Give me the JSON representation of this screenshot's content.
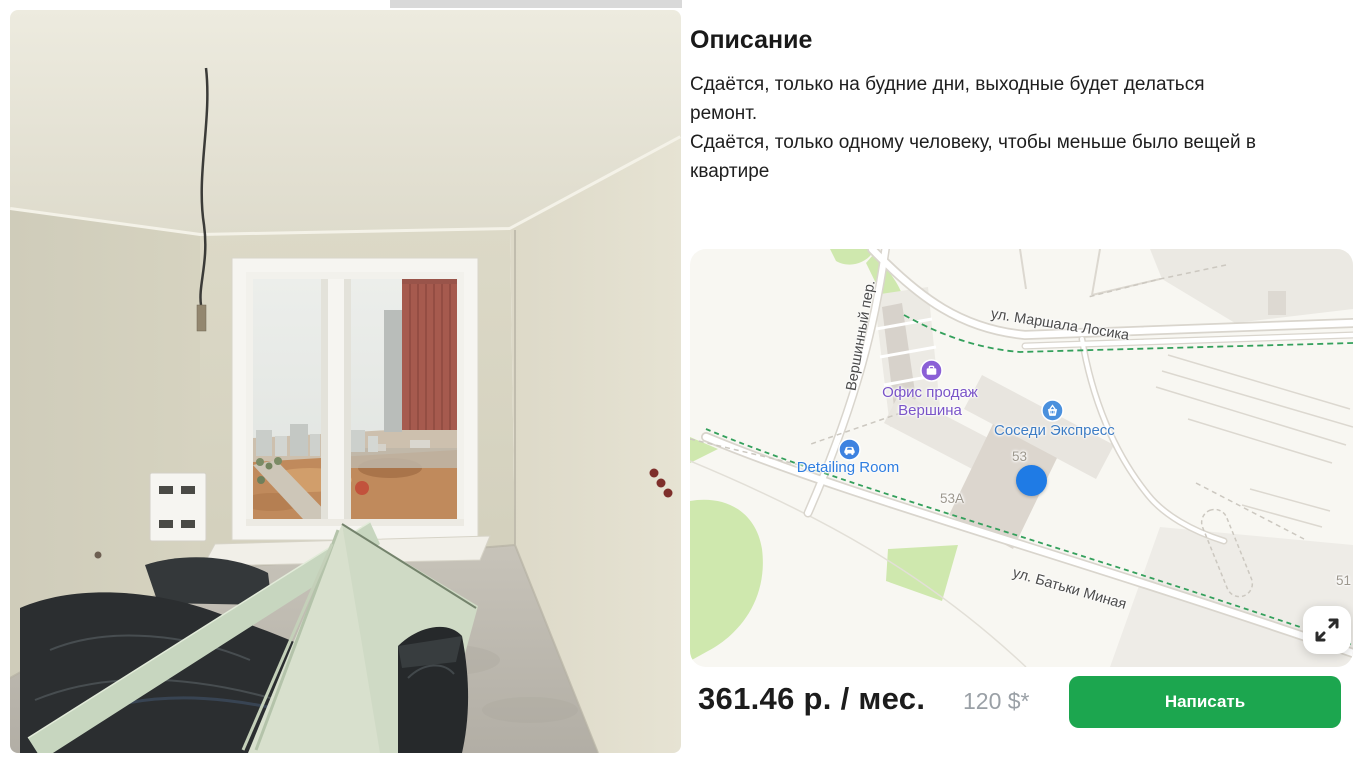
{
  "description": {
    "title": "Описание",
    "lines": [
      "Сдаётся, только на будние дни, выходные будет делаться",
      "ремонт.",
      "Сдаётся, только одному человеку, чтобы меньше было вещей в",
      "квартире"
    ]
  },
  "map": {
    "streets": {
      "vershinny": "Вершинный пер.",
      "losika": "ул. Маршала Лосика",
      "minaya": "ул. Батьки Миная"
    },
    "pois": {
      "sales_office": {
        "line1": "Офис продаж",
        "line2": "Вершина",
        "icon": "briefcase-icon",
        "color": "#8a5fd6"
      },
      "sosedi": {
        "label": "Соседи Экспресс",
        "icon": "basket-icon",
        "color": "#4a90dd"
      },
      "detailing": {
        "label": "Detailing Room",
        "icon": "car-icon",
        "color": "#3d82e0"
      }
    },
    "house_numbers": {
      "n53": "53",
      "n53a": "53А",
      "n51": "51"
    },
    "marker_color": "#1f7be5",
    "expand_icon": "expand-arrows-icon"
  },
  "price": {
    "main": "361.46 р. / мес.",
    "secondary": "120 $*"
  },
  "cta": {
    "label": "Написать",
    "color": "#1ca64f"
  }
}
